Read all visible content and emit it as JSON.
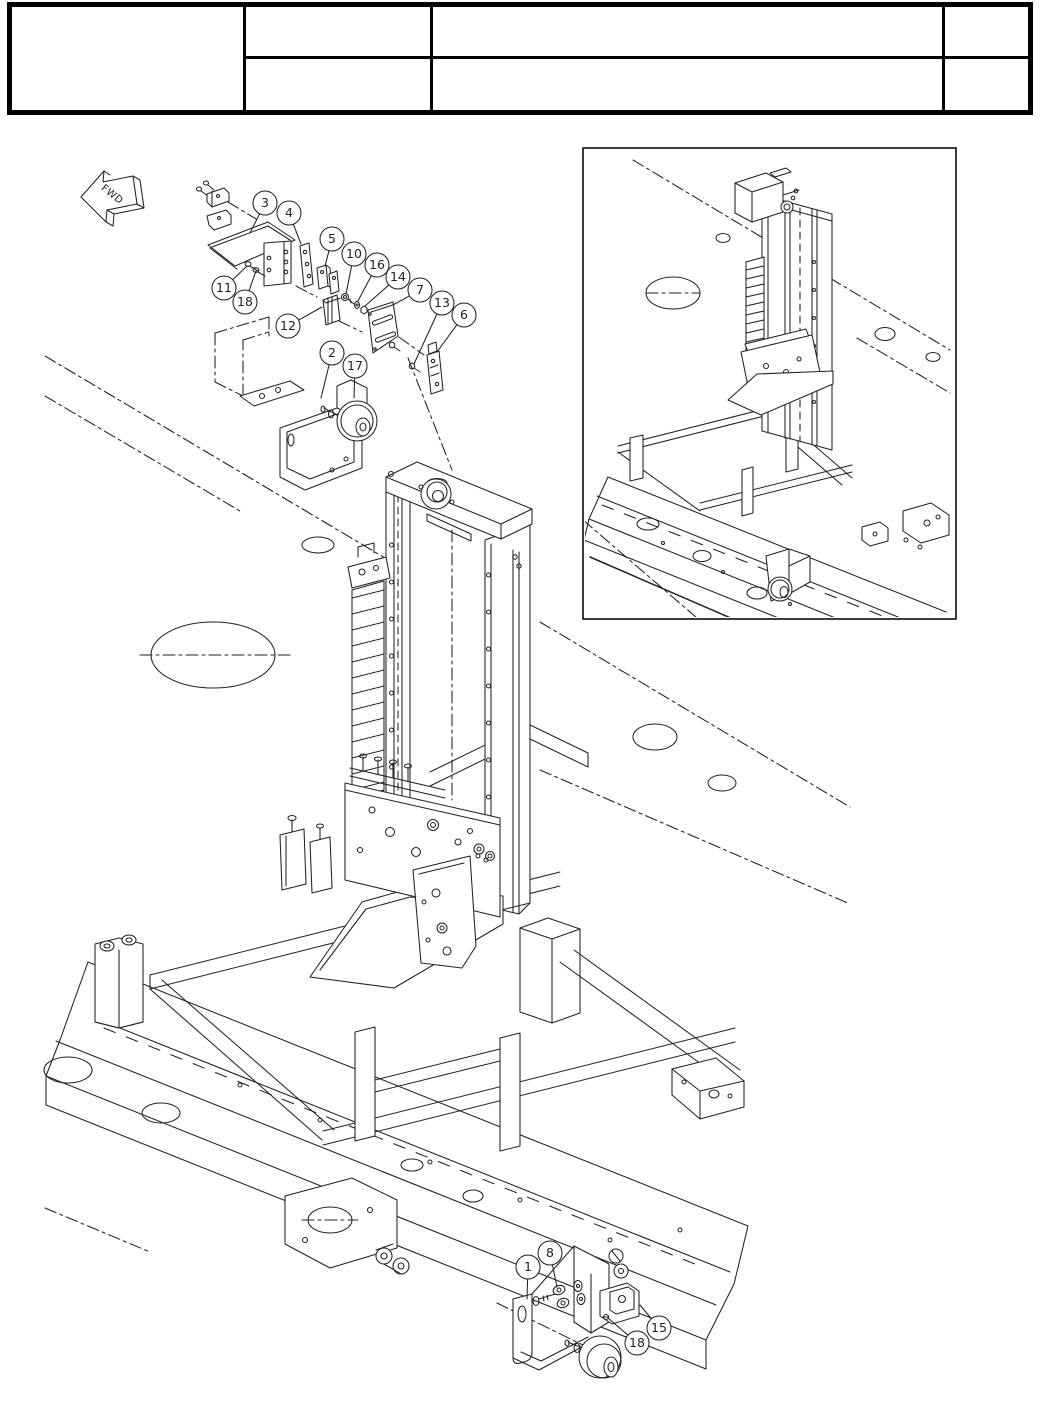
{
  "page": {
    "type": "exploded-parts-diagram",
    "background": "#ffffff",
    "line_color": "#222222"
  },
  "title_block": {
    "rows": 2,
    "columns": 4,
    "all_cells_empty": true,
    "cells_text": ""
  },
  "orientation_marker": {
    "label": "FWD"
  },
  "detail_inset": {
    "present": true
  },
  "callouts": [
    {
      "label": "3",
      "x": 265,
      "y": 203,
      "lx": 250,
      "ly": 233
    },
    {
      "label": "4",
      "x": 289,
      "y": 213,
      "lx": 301,
      "ly": 244
    },
    {
      "label": "5",
      "x": 332,
      "y": 239,
      "lx": 325,
      "ly": 266
    },
    {
      "label": "10",
      "x": 354,
      "y": 254,
      "lx": 346,
      "ly": 294
    },
    {
      "label": "16",
      "x": 377,
      "y": 265,
      "lx": 358,
      "ly": 301
    },
    {
      "label": "14",
      "x": 398,
      "y": 277,
      "lx": 365,
      "ly": 306
    },
    {
      "label": "7",
      "x": 420,
      "y": 290,
      "lx": 393,
      "ly": 305
    },
    {
      "label": "13",
      "x": 442,
      "y": 303,
      "lx": 414,
      "ly": 364
    },
    {
      "label": "6",
      "x": 464,
      "y": 315,
      "lx": 437,
      "ly": 352
    },
    {
      "label": "11",
      "x": 224,
      "y": 288,
      "lx": 247,
      "ly": 266
    },
    {
      "label": "18",
      "x": 245,
      "y": 302,
      "lx": 256,
      "ly": 271
    },
    {
      "label": "12",
      "x": 288,
      "y": 326,
      "lx": 322,
      "ly": 307
    },
    {
      "label": "2",
      "x": 332,
      "y": 353,
      "lx": 321,
      "ly": 398
    },
    {
      "label": "17",
      "x": 355,
      "y": 366,
      "lx": 354,
      "ly": 398
    },
    {
      "label": "1",
      "x": 528,
      "y": 1267,
      "lx": 527,
      "ly": 1299
    },
    {
      "label": "8",
      "x": 550,
      "y": 1253,
      "lx": 557,
      "ly": 1287
    },
    {
      "label": "18",
      "x": 637,
      "y": 1343,
      "lx": 608,
      "ly": 1318
    },
    {
      "label": "15",
      "x": 659,
      "y": 1328,
      "lx": 640,
      "ly": 1305
    }
  ]
}
